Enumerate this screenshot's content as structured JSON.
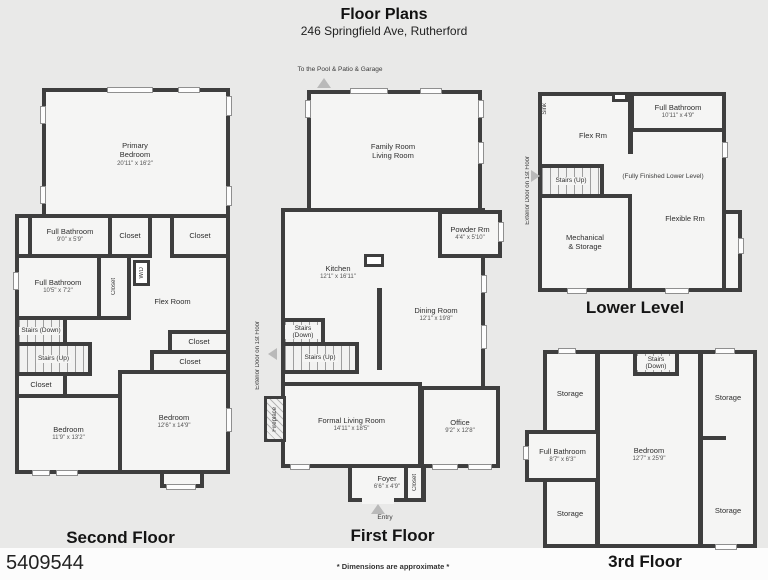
{
  "header": {
    "title": "Floor Plans",
    "subtitle": "246 Springfield Ave, Rutherford"
  },
  "colors": {
    "wall": "#3e3e3e",
    "room_fill": "#f5f5f4",
    "background": "#e9e9e8",
    "window": "#fdfdfd"
  },
  "second_floor": {
    "title": "Second Floor",
    "rooms": {
      "primary_bedroom": {
        "name": "Primary Bedroom",
        "dims": "20'11\" x 16'2\""
      },
      "full_bath_top": {
        "name": "Full Bathroom",
        "dims": "9'0\" x 5'9\""
      },
      "closet_top_1": {
        "name": "Closet"
      },
      "closet_top_2": {
        "name": "Closet"
      },
      "full_bath_mid": {
        "name": "Full Bathroom",
        "dims": "10'5\" x 7'2\""
      },
      "closet_mid": {
        "name": "Closet"
      },
      "wd": {
        "name": "W/D"
      },
      "flex_room": {
        "name": "Flex Room"
      },
      "stairs_down": {
        "name": "Stairs (Down)"
      },
      "stairs_up": {
        "name": "Stairs (Up)"
      },
      "closet_right_1": {
        "name": "Closet"
      },
      "closet_right_2": {
        "name": "Closet"
      },
      "closet_left": {
        "name": "Closet"
      },
      "bedroom_left": {
        "name": "Bedroom",
        "dims": "11'9\" x 13'2\""
      },
      "bedroom_right": {
        "name": "Bedroom",
        "dims": "12'6\" x 14'9\""
      }
    }
  },
  "first_floor": {
    "title": "First Floor",
    "annotations": {
      "pool": "To the Pool & Patio & Garage",
      "exterior_door": "Exterior Door on 1st Floor",
      "entry": "Entry"
    },
    "rooms": {
      "family_room": {
        "name": "Family Room",
        "name2": "Living Room"
      },
      "powder_room": {
        "name": "Powder Rm",
        "dims": "4'4\" x 5'10\""
      },
      "kitchen": {
        "name": "Kitchen",
        "dims": "12'1\" x 16'11\""
      },
      "dining_room": {
        "name": "Dining Room",
        "dims": "12'1\" x 19'8\""
      },
      "stairs_down": {
        "name": "Stairs (Down)"
      },
      "stairs_up": {
        "name": "Stairs (Up)"
      },
      "fireplace": {
        "name": "Fireplace"
      },
      "formal_living_room": {
        "name": "Formal Living Room",
        "dims": "14'11\" x 18'5\""
      },
      "office": {
        "name": "Office",
        "dims": "9'2\" x 12'8\""
      },
      "foyer": {
        "name": "Foyer",
        "dims": "6'6\" x 4'9\""
      },
      "closet": {
        "name": "Closet"
      }
    }
  },
  "lower_level": {
    "title": "Lower Level",
    "annotations": {
      "exterior_door": "Exterior Door on 1st Floor",
      "sink": "Sink",
      "finished_note": "(Fully Finished Lower Level)"
    },
    "rooms": {
      "full_bathroom": {
        "name": "Full Bathroom",
        "dims": "10'11\" x 4'9\""
      },
      "flex_rm": {
        "name": "Flex Rm"
      },
      "stairs_up": {
        "name": "Stairs (Up)"
      },
      "flexible_rm": {
        "name": "Flexible Rm"
      },
      "mechanical_storage": {
        "name": "Mechanical",
        "name2": "& Storage"
      }
    }
  },
  "third_floor": {
    "title": "3rd Floor",
    "rooms": {
      "stairs_down": {
        "name": "Stairs (Down)"
      },
      "storage_top_left": {
        "name": "Storage"
      },
      "storage_top_right": {
        "name": "Storage"
      },
      "full_bathroom": {
        "name": "Full Bathroom",
        "dims": "8'7\" x 6'3\""
      },
      "bedroom": {
        "name": "Bedroom",
        "dims": "12'7\" x 25'9\""
      },
      "storage_bottom_left": {
        "name": "Storage"
      },
      "storage_bottom_right": {
        "name": "Storage"
      }
    }
  },
  "footer": {
    "listing_id": "5409544",
    "disclaimer": "* Dimensions are approximate *"
  }
}
